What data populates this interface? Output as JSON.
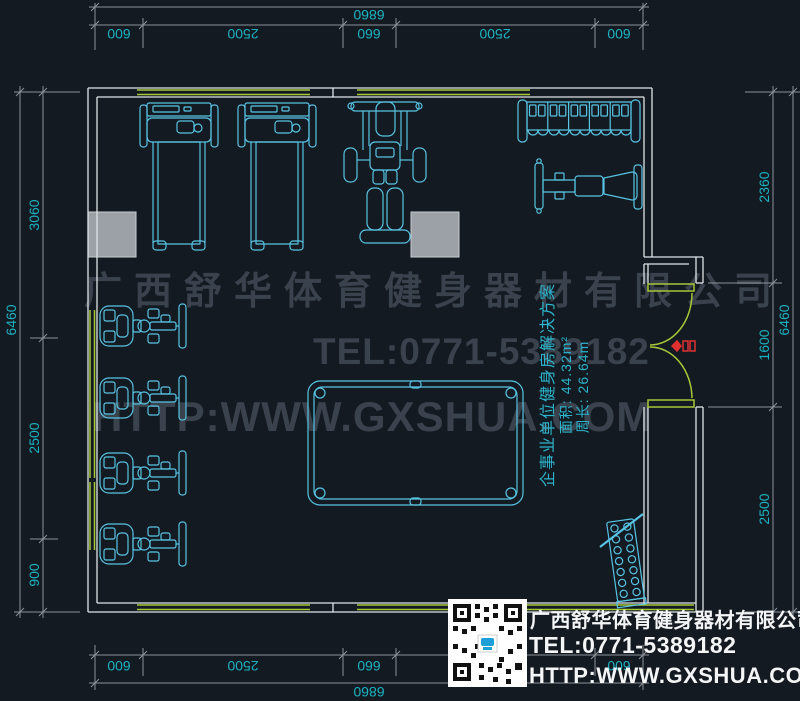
{
  "dims": {
    "top": {
      "total": "6860",
      "segs": [
        "600",
        "2500",
        "660",
        "2500",
        "600"
      ]
    },
    "bottom": {
      "total": "6860",
      "segs": [
        "600",
        "2500",
        "660",
        "2500",
        "600"
      ]
    },
    "left": {
      "total": "6460",
      "segs": [
        "3060",
        "2500",
        "900"
      ]
    },
    "right": {
      "total": "6460",
      "segs": [
        "2360",
        "1600",
        "2500"
      ]
    }
  },
  "watermark": {
    "company": "广西舒华体育健身器材有限公司",
    "tel": "TEL:0771-5389182",
    "url": "HTTP:WWW.GXSHUA.COM"
  },
  "room_info": {
    "title": "企事业单位健身房解决方案",
    "area": "面积: 44.32m²",
    "perimeter": "周长: 26.64m"
  },
  "logo_block": {
    "company": "广西舒华体育健身器材有限公司",
    "tel": "TEL:0771-5389182",
    "url": "HTTP:WWW.GXSHUA.COM"
  },
  "equipment": [
    "treadmill",
    "treadmill",
    "multi-gym-machine",
    "dumbbell-rack",
    "adjustable-bench",
    "elliptical-trainer",
    "elliptical-trainer",
    "elliptical-trainer",
    "elliptical-trainer",
    "billiard-table",
    "plate-rack"
  ],
  "colors": {
    "background": "#131a21",
    "walls": "#dfe4e8",
    "glazing_green": "#a6c838",
    "equipment_cyan": "#58c4e4",
    "dimension_line": "#8e9399",
    "dimension_text": "#1cb3c2",
    "watermark_gray": "#3a434d",
    "info_cyan": "#2db4cc",
    "logo_white": "#f3f5f7",
    "column_gray": "#9ba1a6",
    "door_marker_red": "#e03131"
  }
}
